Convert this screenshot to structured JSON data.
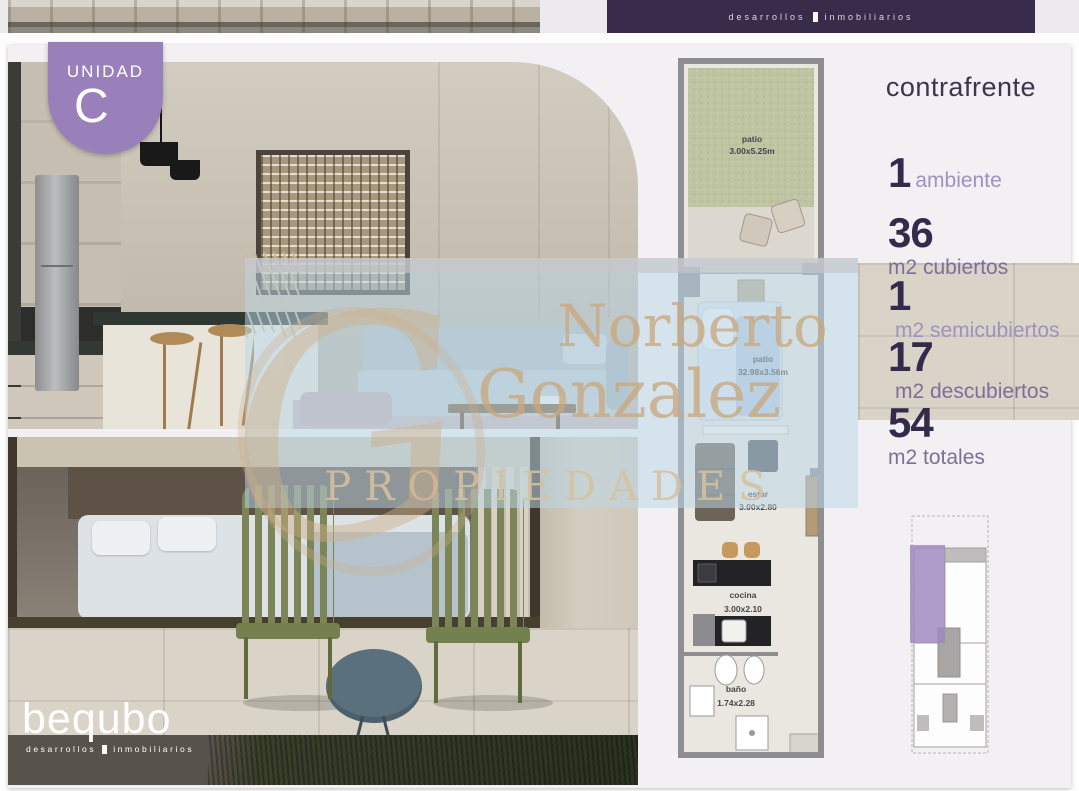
{
  "prev_strip": {
    "tagline_word1": "desarrollos",
    "tagline_word2": "inmobiliarios"
  },
  "badge": {
    "label": "UNIDAD",
    "letter": "C"
  },
  "unit_info": {
    "floor": "PB",
    "orientation": "contrafrente",
    "stats": [
      {
        "value": "1",
        "label": "ambiente"
      },
      {
        "value": "36",
        "label": "m2 cubiertos"
      },
      {
        "value": "1",
        "label": "m2 semicubiertos"
      },
      {
        "value": "17",
        "label": "m2 descubiertos"
      },
      {
        "value": "54",
        "label": "m2 totales"
      }
    ]
  },
  "floorplan": {
    "rooms": [
      {
        "name": "patio",
        "dims": "3.00x5.25m"
      },
      {
        "name": "patio",
        "dims": "32.98x3.56m"
      },
      {
        "name": "estar",
        "dims": "3.00x2.80"
      },
      {
        "name": "cocina",
        "dims": "3.00x2.10"
      },
      {
        "name": "baño",
        "dims": "1.74x2.28"
      }
    ]
  },
  "watermark": {
    "monogram": "G",
    "line1": "Norberto",
    "line2": "Gonzalez",
    "line3": "PROPIEDADES"
  },
  "brand": {
    "name": "bequbo",
    "tagline_word1": "desarrollos",
    "tagline_word2": "inmobiliarios"
  },
  "colors": {
    "accent_purple": "#9a80bb",
    "dark_purple_panel": "#382c4a",
    "stat_number": "#342b4c",
    "stat_label": "#7c6f99",
    "watermark_beige": "#c9a87e",
    "watermark_blue": "#bad6e8",
    "plan_grass": "#c2c8a6"
  }
}
